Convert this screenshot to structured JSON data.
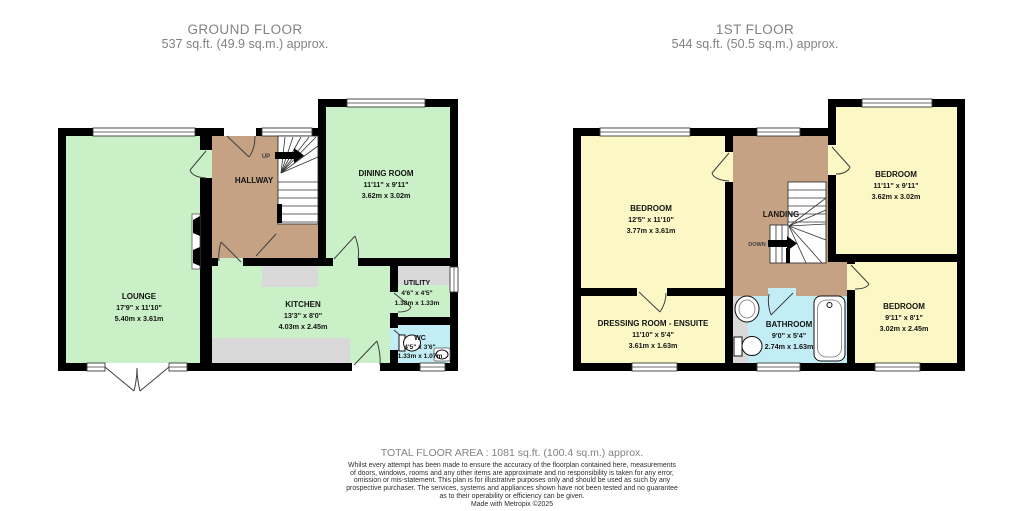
{
  "ground_floor": {
    "title": "GROUND FLOOR",
    "subtitle": "537 sq.ft. (49.9 sq.m.) approx.",
    "stair_direction": "UP",
    "rooms": {
      "lounge": {
        "name": "LOUNGE",
        "imperial": "17'9\" x 11'10\"",
        "metric": "5.40m x 3.61m"
      },
      "hallway": {
        "name": "HALLWAY"
      },
      "dining": {
        "name": "DINING ROOM",
        "imperial": "11'11\" x 9'11\"",
        "metric": "3.62m x 3.02m"
      },
      "kitchen": {
        "name": "KITCHEN",
        "imperial": "13'3\" x 8'0\"",
        "metric": "4.03m x 2.45m"
      },
      "utility": {
        "name": "UTILITY",
        "imperial": "4'6\" x 4'5\"",
        "metric": "1.38m x 1.33m"
      },
      "wc": {
        "name": "WC",
        "imperial": "4'5\" x 3'6\"",
        "metric": "1.33m x 1.07m"
      }
    }
  },
  "first_floor": {
    "title": "1ST FLOOR",
    "subtitle": "544 sq.ft. (50.5 sq.m.) approx.",
    "stair_direction": "DOWN",
    "rooms": {
      "bedroom_front": {
        "name": "BEDROOM",
        "imperial": "12'5\" x 11'10\"",
        "metric": "3.77m x 3.61m"
      },
      "landing": {
        "name": "LANDING"
      },
      "bedroom_rear": {
        "name": "BEDROOM",
        "imperial": "11'11\" x 9'11\"",
        "metric": "3.62m x 3.02m"
      },
      "bedroom_side": {
        "name": "BEDROOM",
        "imperial": "9'11\" x 8'1\"",
        "metric": "3.02m x 2.45m"
      },
      "dressing": {
        "name": "DRESSING ROOM - ENSUITE",
        "imperial": "11'10\" x 5'4\"",
        "metric": "3.61m x 1.63m"
      },
      "bathroom": {
        "name": "BATHROOM",
        "imperial": "9'0\" x 5'4\"",
        "metric": "2.74m x 1.63m"
      }
    }
  },
  "footer": {
    "total_area": "TOTAL FLOOR AREA : 1081 sq.ft. (100.4 sq.m.) approx.",
    "disclaimer_lines": [
      "Whilst every attempt has been made to ensure the accuracy of the floorplan contained here, measurements",
      "of doors, windows, rooms and any other items are approximate and no responsibility is taken for any error,",
      "omission or mis-statement. This plan is for illustrative purposes only and should be used as such by any",
      "prospective purchaser. The services, systems and appliances shown have not been tested and no guarantee",
      "as to their operability or efficiency can be given."
    ],
    "credit": "Made with Metropix ©2025"
  },
  "colors": {
    "wall": "#000000",
    "reception_green": "#c9f0c6",
    "hall_tan": "#c5a284",
    "bedroom_yellow": "#fbf8c5",
    "bath_blue": "#c3edf5",
    "counter_gray": "#d9d9d9",
    "header_gray": "#828282"
  }
}
